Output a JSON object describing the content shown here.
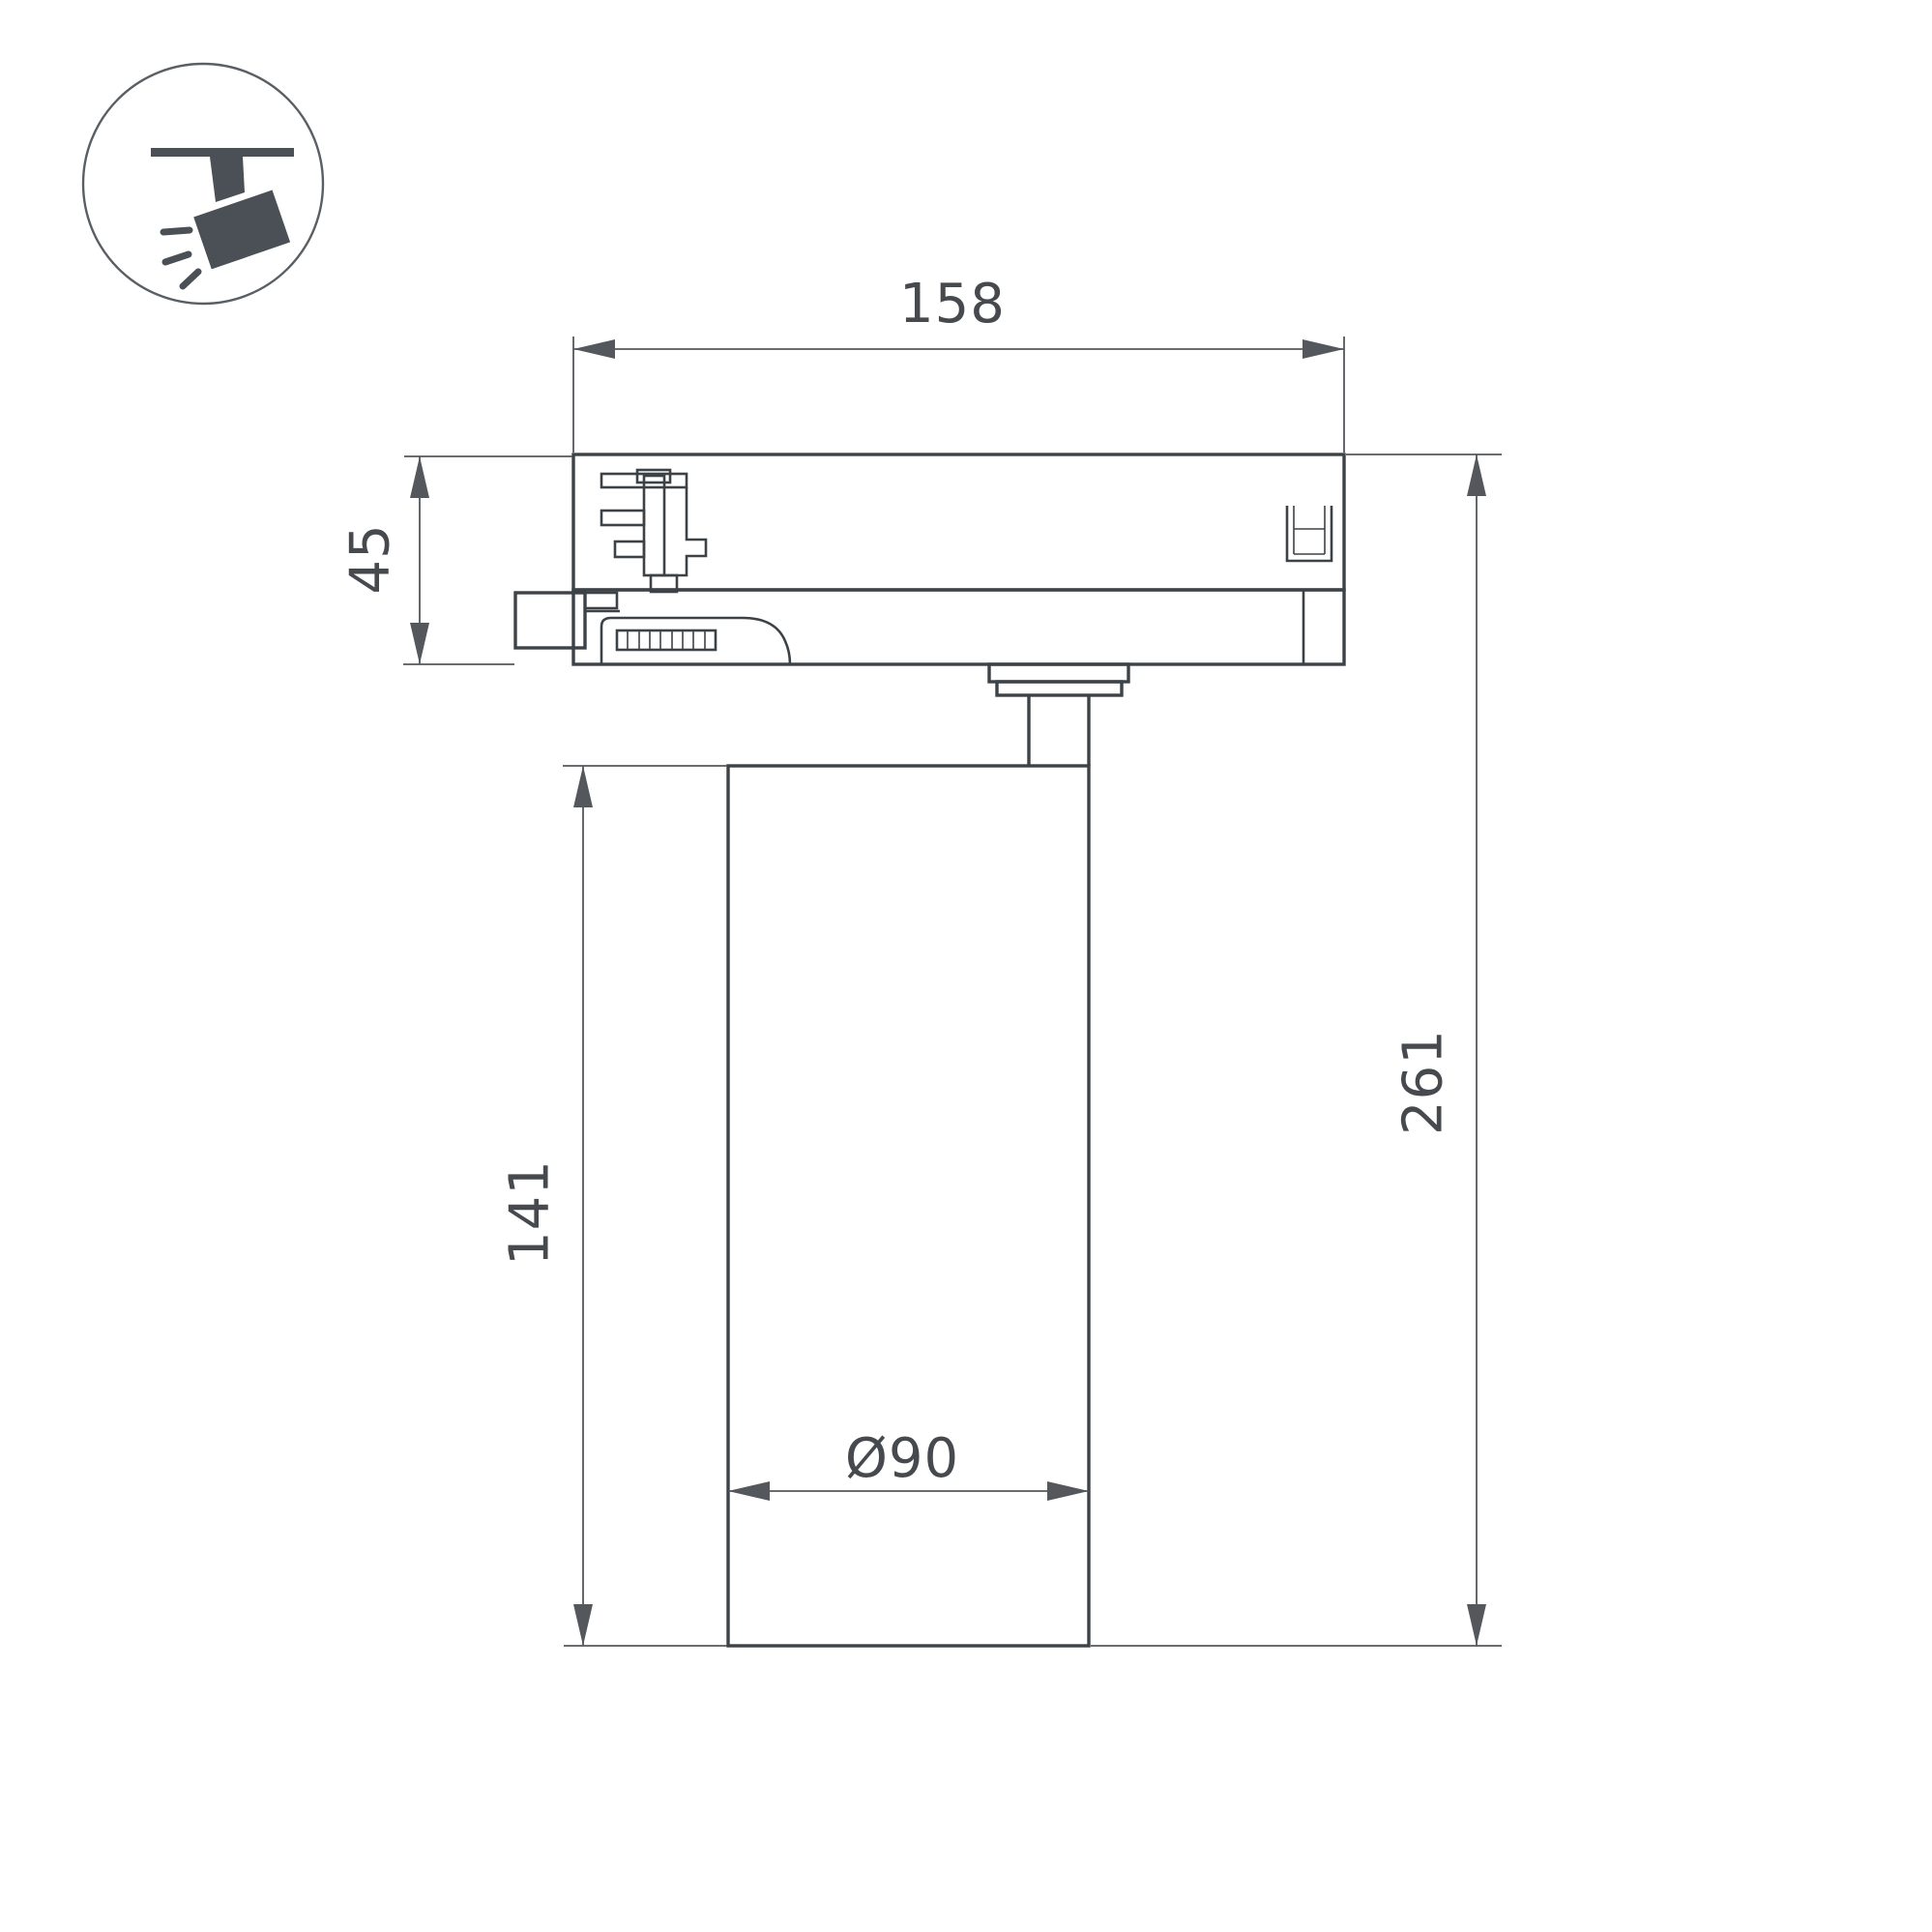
{
  "colors": {
    "outline": "#3d4246",
    "dimension": "#54585c",
    "label": "#46494d",
    "icon_fill": "#4a5055",
    "icon_stroke": "#5a5f64"
  },
  "icon": {
    "meaning": "ceiling-track-spotlight"
  },
  "dimensions": {
    "track_width": "158",
    "adapter_height": "45",
    "body_height": "141",
    "total_height": "261",
    "body_diameter": "Ø90"
  }
}
